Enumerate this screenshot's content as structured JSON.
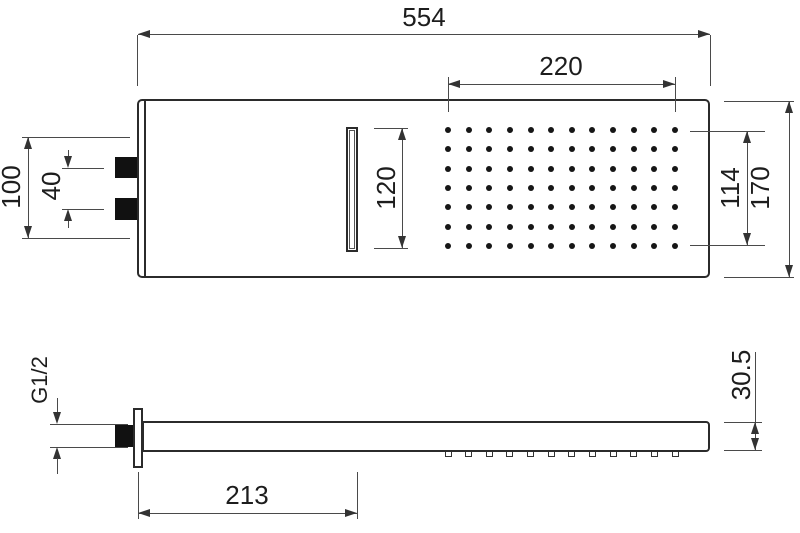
{
  "title": "Shower head dimensional drawing",
  "dimensions": {
    "overall_width": "554",
    "spray_field_width": "220",
    "slot_length": "120",
    "spray_field_height": "114",
    "head_height": "170",
    "mounting_height": "100",
    "inlet_spacing": "40",
    "thread_size": "G1/2",
    "arm_length": "213",
    "head_thickness": "30.5"
  },
  "top_view": {
    "spray_grid": {
      "rows": 7,
      "columns": 12
    },
    "inlet_count": 2
  },
  "side_view": {
    "nozzle_count": 12
  },
  "colors": {
    "background": "#ffffff",
    "outline": "#2b2b2b",
    "dimension_line": "#4a4a4a",
    "text": "#1d1d1d",
    "fill_black": "#111111"
  }
}
